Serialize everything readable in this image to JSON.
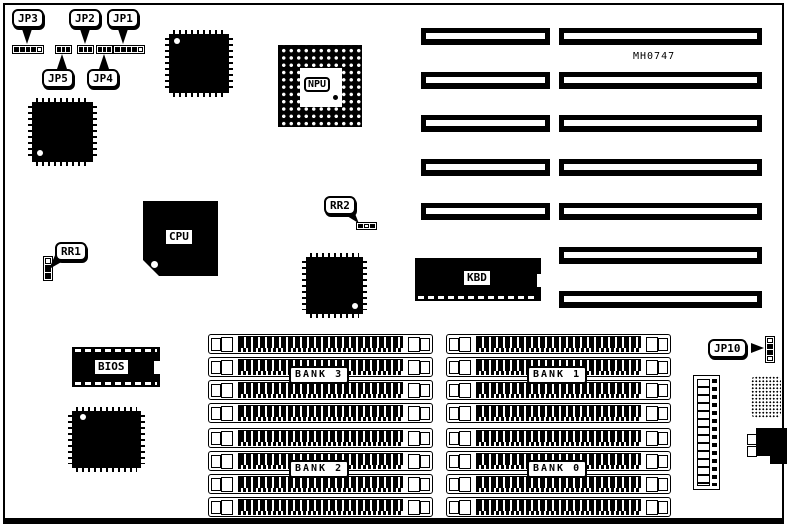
{
  "board": {
    "model": "MH0747"
  },
  "jumpers": {
    "jp1": {
      "label": "JP1"
    },
    "jp2": {
      "label": "JP2"
    },
    "jp3": {
      "label": "JP3"
    },
    "jp4": {
      "label": "JP4"
    },
    "jp5": {
      "label": "JP5"
    },
    "jp10": {
      "label": "JP10"
    }
  },
  "resistor_packs": {
    "rr1": {
      "label": "RR1"
    },
    "rr2": {
      "label": "RR2"
    }
  },
  "chips": {
    "npu": {
      "label": "NPU"
    },
    "cpu": {
      "label": "CPU"
    },
    "kbd": {
      "label": "KBD"
    },
    "bios": {
      "label": "BIOS"
    }
  },
  "memory": {
    "sockets_per_bank": 4,
    "banks": [
      {
        "label": "BANK 3"
      },
      {
        "label": "BANK 1"
      },
      {
        "label": "BANK 2"
      },
      {
        "label": "BANK 0"
      }
    ]
  },
  "expansion_slots": {
    "rows": 7,
    "rows_with_short_segment": 5
  }
}
